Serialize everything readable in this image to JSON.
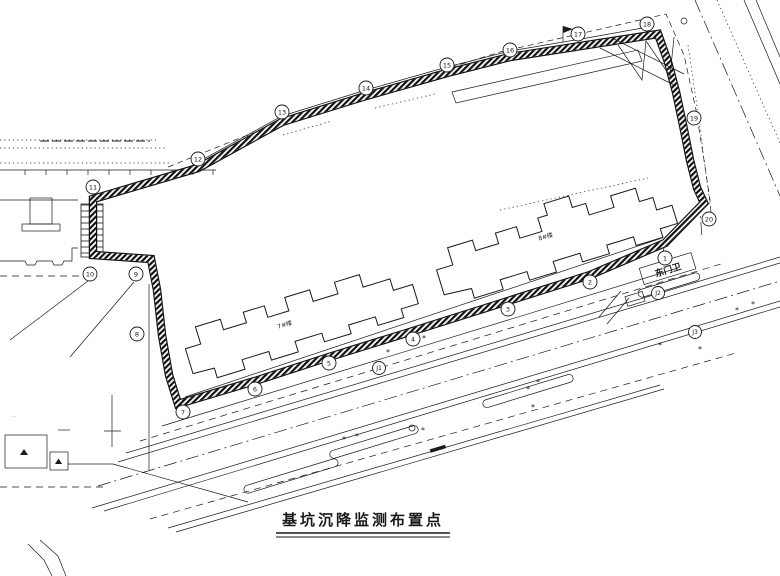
{
  "colors": {
    "ink": "#1a1a1a",
    "paper": "#ffffff"
  },
  "title": {
    "text": "基坑沉降监测布置点"
  },
  "labels": {
    "east_gate": "东门卫",
    "building_a": "7#楼",
    "building_b": "8#楼",
    "tiny_note": "⋯"
  },
  "monitoring_points": [
    {
      "n": "1",
      "x": 665,
      "y": 258
    },
    {
      "n": "2",
      "x": 590,
      "y": 282
    },
    {
      "n": "3",
      "x": 508,
      "y": 309
    },
    {
      "n": "4",
      "x": 413,
      "y": 339
    },
    {
      "n": "5",
      "x": 329,
      "y": 363
    },
    {
      "n": "6",
      "x": 255,
      "y": 389
    },
    {
      "n": "7",
      "x": 183,
      "y": 412
    },
    {
      "n": "8",
      "x": 137,
      "y": 334
    },
    {
      "n": "9",
      "x": 136,
      "y": 274
    },
    {
      "n": "10",
      "x": 90,
      "y": 274
    },
    {
      "n": "11",
      "x": 93,
      "y": 187
    },
    {
      "n": "12",
      "x": 198,
      "y": 159
    },
    {
      "n": "13",
      "x": 282,
      "y": 112
    },
    {
      "n": "14",
      "x": 366,
      "y": 88
    },
    {
      "n": "15",
      "x": 447,
      "y": 65
    },
    {
      "n": "16",
      "x": 510,
      "y": 50
    },
    {
      "n": "17",
      "x": 578,
      "y": 34
    },
    {
      "n": "18",
      "x": 647,
      "y": 24
    },
    {
      "n": "19",
      "x": 694,
      "y": 118
    },
    {
      "n": "20",
      "x": 709,
      "y": 219
    }
  ],
  "benchmarks": [
    {
      "n": "J1",
      "x": 379,
      "y": 368
    },
    {
      "n": "J2",
      "x": 658,
      "y": 293
    },
    {
      "n": "J3",
      "x": 695,
      "y": 332
    }
  ],
  "tree_markers": [
    {
      "x": 424,
      "y": 338
    },
    {
      "x": 388,
      "y": 352
    },
    {
      "x": 344,
      "y": 439
    },
    {
      "x": 357,
      "y": 436
    },
    {
      "x": 423,
      "y": 430
    },
    {
      "x": 528,
      "y": 389
    },
    {
      "x": 538,
      "y": 382
    },
    {
      "x": 533,
      "y": 407
    },
    {
      "x": 660,
      "y": 345
    },
    {
      "x": 700,
      "y": 349
    },
    {
      "x": 737,
      "y": 310
    },
    {
      "x": 753,
      "y": 304
    }
  ]
}
